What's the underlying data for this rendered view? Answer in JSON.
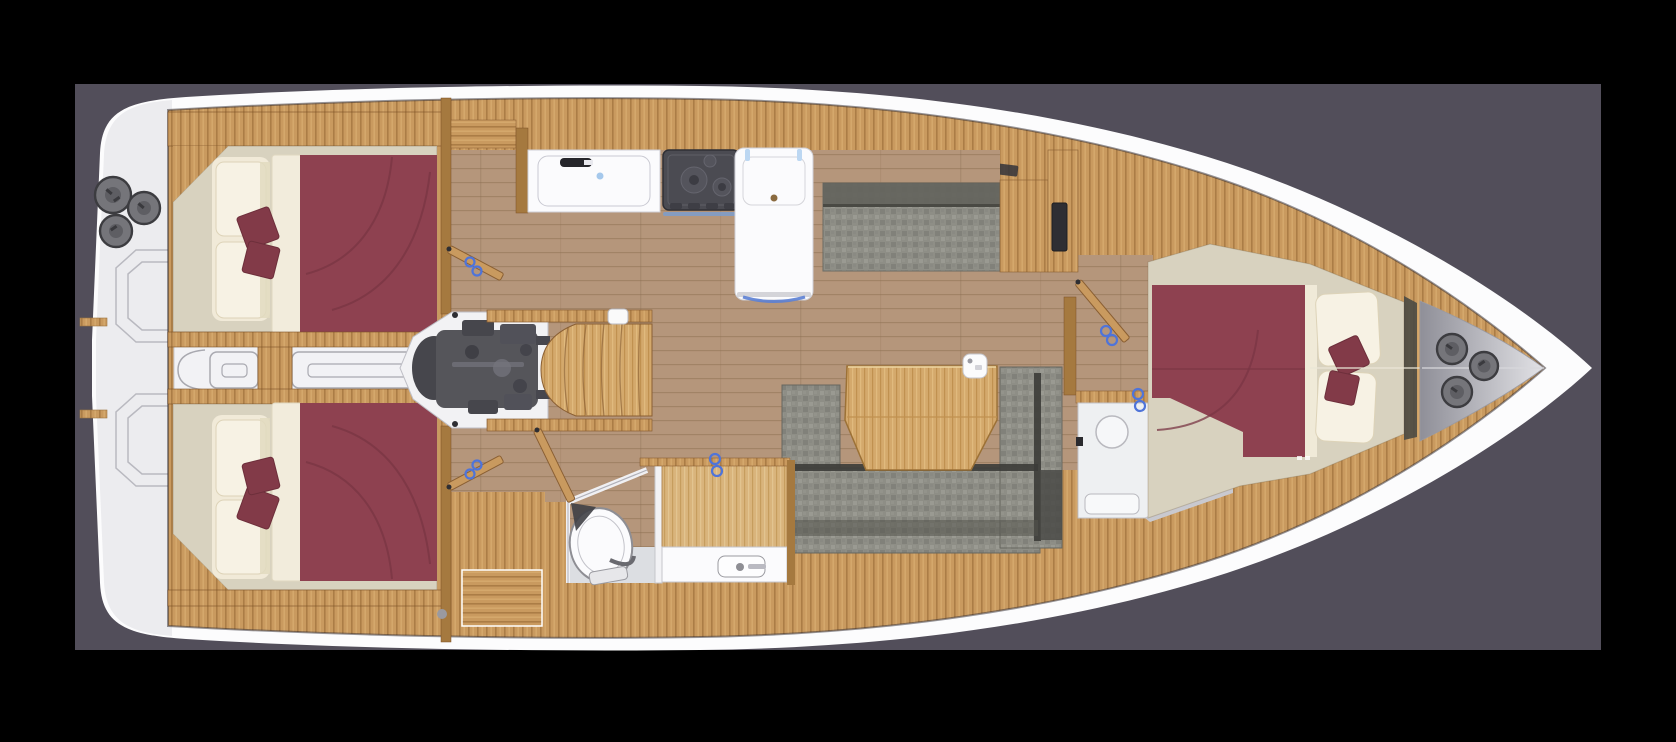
{
  "figure": {
    "title": "Sailing yacht interior layout — top-down deck floor plan",
    "view": "plan view, bow to the right, stern to the left",
    "layout_summary": "3 cabins, 2 heads with shower, galley, U-shaped salon sofa, engine compartment, companionway steps"
  },
  "palette": {
    "background": "#000000",
    "canvas": "#524e5a",
    "hull": "#fcfcfd",
    "platform": "#ececef",
    "platform-line": "#b9b9c0",
    "wood-deck": "#c99a5f",
    "wood-floor": "#b5967b",
    "wood-table": "#d4a96c",
    "wood-wall": "#a5793f",
    "wood-edge": "#8a5f33",
    "cabin-floor": "#d8d2bf",
    "linen": "#f1ead8",
    "linen-hi": "#f7f2e4",
    "bed": "#8e4150",
    "bed-seam": "#7a3644",
    "cushion": "#823a48",
    "fabric": "#8e8e86",
    "fabric-dark": "#63635c",
    "engine": "#55555a",
    "engine-dark": "#46464c",
    "fixture": "#fbfbfd",
    "fixture-line": "#9a9aa0",
    "gray-floor": "#dcdee2",
    "handle": "#4f74d9",
    "winch": "#75757a",
    "winch-edge": "#3c3c40",
    "tv": "#2e2e33"
  },
  "rooms": {
    "swim_platform": {
      "label": "Stern swim platform and transom lockers"
    },
    "aft_cabin_port": {
      "label": "Aft cabin port side — double berth with seat"
    },
    "aft_cabin_starboard": {
      "label": "Aft cabin starboard side — double berth with seat"
    },
    "corridor": {
      "label": "Central stern corridor between aft cabins"
    },
    "engine_room": {
      "label": "Engine compartment under companionway"
    },
    "companionway": {
      "label": "Companionway steps to cockpit"
    },
    "galley": {
      "label": "Galley — sink, two-burner stove, island unit"
    },
    "settee": {
      "label": "Starboard settee bench with media cabinet"
    },
    "salon": {
      "label": "Salon — U-shaped sofa with dining table"
    },
    "aft_head": {
      "label": "Aft head — toilet, separate shower, washbasin"
    },
    "forward_head": {
      "label": "Forward head — washbasin, toilet, shower tray"
    },
    "forward_cabin": {
      "label": "Forward owner cabin — double berth"
    },
    "bow_locker": {
      "label": "Bow anchor locker with winches"
    }
  },
  "fixtures": {
    "stern_winches": 3,
    "bow_winches": 3,
    "stove_burners": 2,
    "toilets": 2,
    "showers": 2,
    "double_berths": 3
  }
}
